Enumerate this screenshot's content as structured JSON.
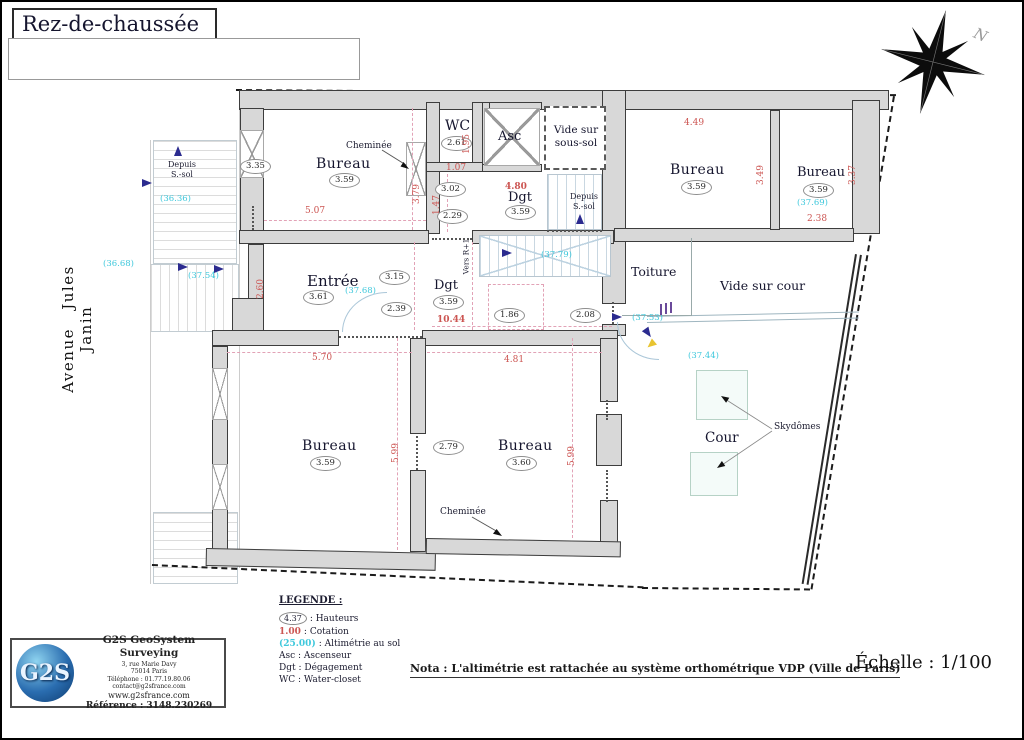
{
  "title": "Rez-de-chaussée",
  "compass": {
    "north": "N"
  },
  "street": "Avenue  Jules  Janin",
  "rooms": {
    "bureau_tl": {
      "label": "Bureau",
      "height": "3.59",
      "dim_w": "5.07",
      "dim_h": "3.79"
    },
    "wc": {
      "label": "WC",
      "height": "2.61",
      "dim_h": "1.95"
    },
    "hall": {
      "height_a": "3.02",
      "height_b": "2.29",
      "dim_w": "1.07",
      "dim_h": "1.47"
    },
    "asc": {
      "label": "Asc"
    },
    "vide_ss": {
      "label": "Vide sur sous-sol"
    },
    "dgt_top": {
      "label": "Dgt",
      "height": "3.59",
      "dim_w": "4.80"
    },
    "bureau_tr": {
      "label": "Bureau",
      "height": "3.59",
      "dim_w": "4.49",
      "dim_h": "3.49"
    },
    "bureau_fr": {
      "label": "Bureau",
      "height": "3.59",
      "alti": "(37.69)",
      "dim_w": "2.38",
      "dim_h": "3.37"
    },
    "entree": {
      "label": "Entrée",
      "height": "3.61",
      "alti": "(37.68)",
      "dim_h": "2.60"
    },
    "dgt_mid": {
      "label": "Dgt",
      "height": "3.59",
      "dim_w": "10.44"
    },
    "toiture": {
      "label": "Toiture"
    },
    "vide_cour": {
      "label": "Vide sur cour"
    },
    "cour": {
      "label": "Cour",
      "alti": "(37.44)"
    },
    "bureau_bl": {
      "label": "Bureau",
      "height": "3.59",
      "dim_w": "5.70",
      "dim_h": "5.99"
    },
    "bureau_bm": {
      "label": "Bureau",
      "height": "3.60",
      "dim_w": "4.81",
      "dim_h": "5.99"
    }
  },
  "heights": {
    "left_wall": "3.35",
    "h315": "3.15",
    "h239": "2.39",
    "h186": "1.86",
    "h208": "2.08",
    "h279": "2.79"
  },
  "alti": {
    "street_top": "(36.36)",
    "street_mid": "(36.68)",
    "entrance": "(37.54)",
    "stairs": "(37.79)",
    "court_door": "(37.53)"
  },
  "annotations": {
    "cheminee_top": "Cheminée",
    "cheminee_bottom": "Cheminée",
    "depuis_left": "Depuis\nS.-sol",
    "depuis_mid": "Depuis\nS.-sol",
    "vers_r1": "Vers R+1",
    "skydomes": "Skydômes"
  },
  "legend": {
    "title": "LEGENDE :",
    "hauteurs_symbol": "4.37",
    "hauteurs_text": ": Hauteurs",
    "cotation_symbol": "1.00",
    "cotation_text": ": Cotation",
    "alti_symbol": "(25.00)",
    "alti_text": ": Altimétrie au sol",
    "asc": "Asc : Ascenseur",
    "dgt": "Dgt : Dégagement",
    "wc": "WC : Water-closet"
  },
  "nota": "Nota : L'altimétrie est rattachée au système orthométrique VDP (Ville de Paris)",
  "scale": "Échelle : 1/100",
  "firm": {
    "logo": "G2S",
    "name": "G2S GeoSystem Surveying",
    "addr1": "3, rue Marie Davy",
    "addr2": "75014 Paris",
    "phone": "Téléphone : 01.77.19.80.06",
    "email": "contact@g2sfrance.com",
    "web": "www.g2sfrance.com",
    "ref": "Référence : 3148.230269"
  },
  "colors": {
    "cotation": "#cc5552",
    "altimetrie": "#3fc8dc",
    "arrow": "#2b2b8f",
    "wall_fill": "#d8d8d8"
  }
}
